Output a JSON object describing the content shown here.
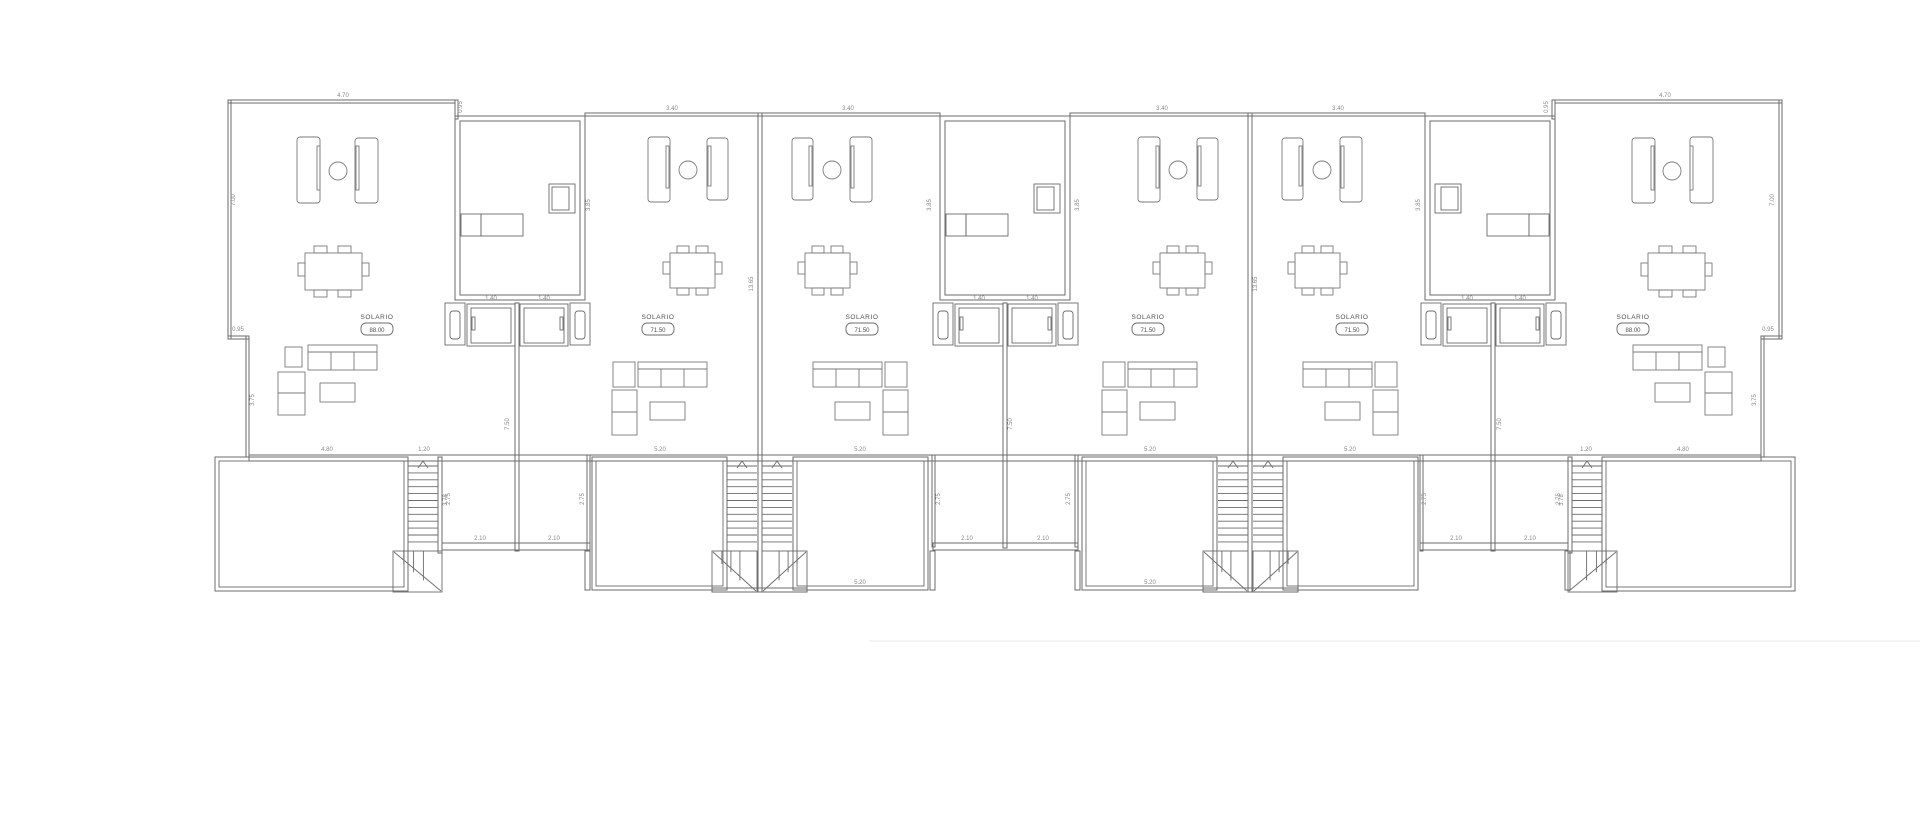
{
  "page": {
    "background": "#ffffff",
    "line_color": "#6b6b6b",
    "furniture_color": "#7a7a7a",
    "dim_color": "#8a8a8a",
    "label_color": "#4f4f4f",
    "edge_shadow_color": "#e9e9e9"
  },
  "units": [
    {
      "id": "A",
      "room_label": "SOLARIO",
      "area": "88.00",
      "lx": 377,
      "ly": 315
    },
    {
      "id": "B",
      "room_label": "SOLARIO",
      "area": "71.50",
      "lx": 658,
      "ly": 315
    },
    {
      "id": "C",
      "room_label": "SOLARIO",
      "area": "71.50",
      "lx": 862,
      "ly": 315
    },
    {
      "id": "D",
      "room_label": "SOLARIO",
      "area": "71.50",
      "lx": 1148,
      "ly": 315
    },
    {
      "id": "E",
      "room_label": "SOLARIO",
      "area": "71.50",
      "lx": 1352,
      "ly": 315
    },
    {
      "id": "F",
      "room_label": "SOLARIO",
      "area": "88.00",
      "lx": 1633,
      "ly": 315
    }
  ],
  "dimensions": [
    {
      "t": "4.70",
      "x": 343,
      "y": 97,
      "r": 0
    },
    {
      "t": "4.70",
      "x": 1665,
      "y": 97,
      "r": 0
    },
    {
      "t": "3.40",
      "x": 672,
      "y": 110,
      "r": 0
    },
    {
      "t": "3.40",
      "x": 848,
      "y": 110,
      "r": 0
    },
    {
      "t": "3.40",
      "x": 1162,
      "y": 110,
      "r": 0
    },
    {
      "t": "3.40",
      "x": 1338,
      "y": 110,
      "r": 0
    },
    {
      "t": "0.95",
      "x": 462,
      "y": 107,
      "r": 1
    },
    {
      "t": "0.95",
      "x": 1548,
      "y": 107,
      "r": 1
    },
    {
      "t": "7.00",
      "x": 235,
      "y": 200,
      "r": 1
    },
    {
      "t": "7.00",
      "x": 1774,
      "y": 200,
      "r": 1
    },
    {
      "t": "0.95",
      "x": 238,
      "y": 331,
      "r": 0
    },
    {
      "t": "0.95",
      "x": 1768,
      "y": 331,
      "r": 0
    },
    {
      "t": "3.75",
      "x": 254,
      "y": 400,
      "r": 1
    },
    {
      "t": "3.75",
      "x": 1756,
      "y": 400,
      "r": 1
    },
    {
      "t": "3.85",
      "x": 590,
      "y": 205,
      "r": 1
    },
    {
      "t": "3.85",
      "x": 931,
      "y": 205,
      "r": 1
    },
    {
      "t": "3.85",
      "x": 1079,
      "y": 205,
      "r": 1
    },
    {
      "t": "3.85",
      "x": 1420,
      "y": 205,
      "r": 1
    },
    {
      "t": "13.65",
      "x": 753,
      "y": 284,
      "r": 1
    },
    {
      "t": "13.65",
      "x": 1257,
      "y": 284,
      "r": 1
    },
    {
      "t": "7.50",
      "x": 509,
      "y": 424,
      "r": 1
    },
    {
      "t": "7.50",
      "x": 1012,
      "y": 424,
      "r": 1
    },
    {
      "t": "7.50",
      "x": 1501,
      "y": 424,
      "r": 1
    },
    {
      "t": "4.80",
      "x": 327,
      "y": 451,
      "r": 0
    },
    {
      "t": "4.80",
      "x": 1683,
      "y": 451,
      "r": 0
    },
    {
      "t": "1.20",
      "x": 424,
      "y": 451,
      "r": 0
    },
    {
      "t": "1.20",
      "x": 1586,
      "y": 451,
      "r": 0
    },
    {
      "t": "5.20",
      "x": 660,
      "y": 451,
      "r": 0
    },
    {
      "t": "5.20",
      "x": 860,
      "y": 451,
      "r": 0
    },
    {
      "t": "5.20",
      "x": 1150,
      "y": 451,
      "r": 0
    },
    {
      "t": "5.20",
      "x": 1350,
      "y": 451,
      "r": 0
    },
    {
      "t": "5.20",
      "x": 860,
      "y": 584,
      "r": 0
    },
    {
      "t": "5.20",
      "x": 1150,
      "y": 584,
      "r": 0
    },
    {
      "t": "2.75",
      "x": 450,
      "y": 499,
      "r": 1
    },
    {
      "t": "2.75",
      "x": 584,
      "y": 499,
      "r": 1
    },
    {
      "t": "2.75",
      "x": 940,
      "y": 499,
      "r": 1
    },
    {
      "t": "2.75",
      "x": 1070,
      "y": 499,
      "r": 1
    },
    {
      "t": "2.75",
      "x": 1426,
      "y": 499,
      "r": 1
    },
    {
      "t": "2.75",
      "x": 1560,
      "y": 499,
      "r": 1
    },
    {
      "t": "2.10",
      "x": 480,
      "y": 540,
      "r": 0
    },
    {
      "t": "2.10",
      "x": 554,
      "y": 540,
      "r": 0
    },
    {
      "t": "2.10",
      "x": 967,
      "y": 540,
      "r": 0
    },
    {
      "t": "2.10",
      "x": 1043,
      "y": 540,
      "r": 0
    },
    {
      "t": "2.10",
      "x": 1456,
      "y": 540,
      "r": 0
    },
    {
      "t": "2.10",
      "x": 1530,
      "y": 540,
      "r": 0
    },
    {
      "t": "3.78",
      "x": 447,
      "y": 500,
      "r": 1
    },
    {
      "t": "3.78",
      "x": 1563,
      "y": 500,
      "r": 1
    },
    {
      "t": "1.40",
      "x": 491,
      "y": 300,
      "r": 0
    },
    {
      "t": "1.40",
      "x": 544,
      "y": 300,
      "r": 0
    },
    {
      "t": "1.40",
      "x": 979,
      "y": 300,
      "r": 0
    },
    {
      "t": "1.40",
      "x": 1032,
      "y": 300,
      "r": 0
    },
    {
      "t": "1.40",
      "x": 1467,
      "y": 300,
      "r": 0
    },
    {
      "t": "1.40",
      "x": 1520,
      "y": 300,
      "r": 0
    }
  ]
}
